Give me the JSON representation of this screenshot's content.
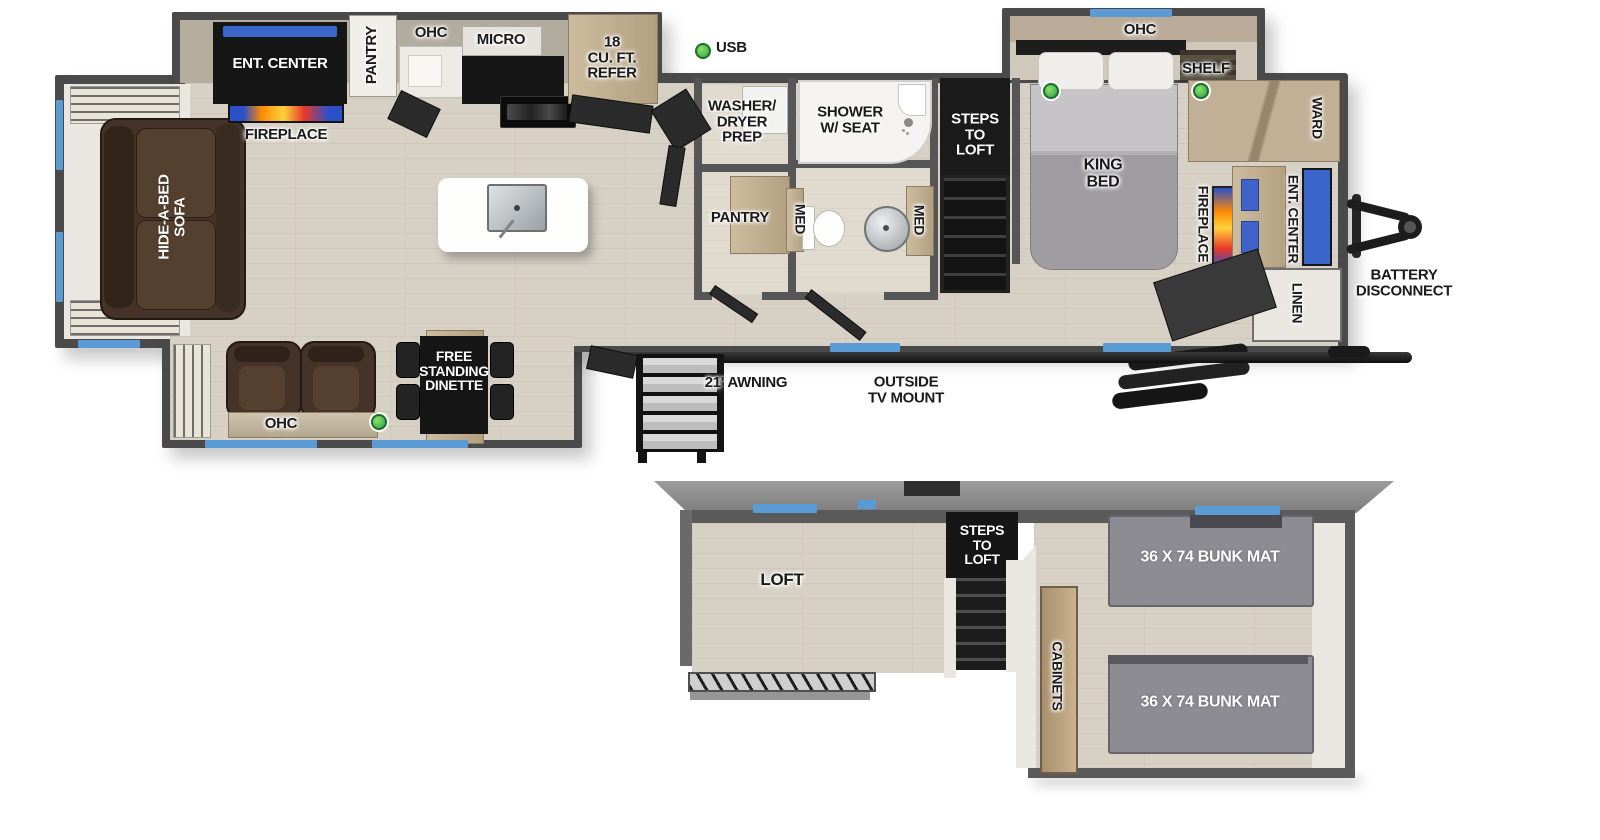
{
  "title": "RV destination-trailer floor plan with loft",
  "colors": {
    "accent_blue": "#5b9bd5",
    "usb_green": "#2fa043",
    "wall": "#4a4a4a",
    "floor": "#d7d0c5",
    "flame_orange": "#ff8a00",
    "sofa_brown": "#45332a",
    "mat_gray": "#8e8c93"
  },
  "main": {
    "rear_slide": {
      "sofa": "HIDE-A-BED\nSOFA"
    },
    "kitchen_slide": {
      "ent_center": "ENT. CENTER",
      "pantry": "PANTRY",
      "ohc": "OHC",
      "micro": "MICRO",
      "refer": "18\nCU. FT.\nREFER"
    },
    "living": {
      "fireplace": "FIREPLACE",
      "usb": "USB"
    },
    "bath": {
      "washer_dryer": "WASHER/\nDRYER\nPREP",
      "shower": "SHOWER\nW/ SEAT",
      "pantry": "PANTRY",
      "med_left": "MED",
      "med_right": "MED",
      "steps_to_loft": "STEPS\nTO\nLOFT"
    },
    "bedroom": {
      "king_bed": "KING\nBED",
      "ohc": "OHC",
      "shelf": "SHELF",
      "ward": "WARD",
      "fireplace": "FIREPLACE",
      "ent_center": "ENT. CENTER",
      "linen": "LINEN"
    },
    "front": {
      "battery_disconnect": "BATTERY\nDISCONNECT"
    },
    "dinette_slide": {
      "ohc": "OHC",
      "dinette": "FREE\nSTANDING\nDINETTE"
    },
    "exterior": {
      "awning": "21' AWNING",
      "tv_mount": "OUTSIDE\nTV MOUNT"
    }
  },
  "loft": {
    "loft": "LOFT",
    "steps_to_loft": "STEPS\nTO\nLOFT",
    "cabinets": "CABINETS",
    "bunk_top": "36 X 74 BUNK MAT",
    "bunk_bottom": "36 X 74 BUNK MAT"
  }
}
